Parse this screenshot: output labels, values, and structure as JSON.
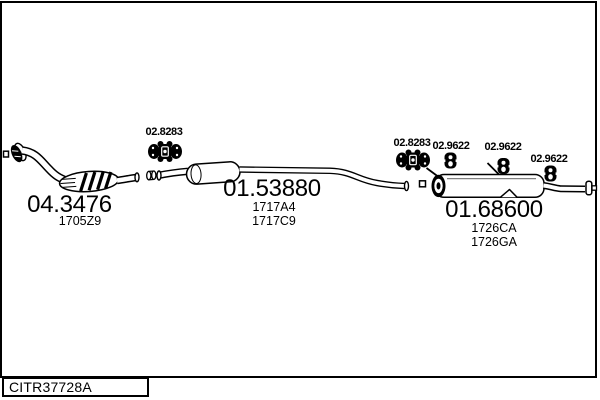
{
  "parts": [
    {
      "number": "04.3476",
      "subs": [
        "1705Z9"
      ]
    },
    {
      "number": "01.53880",
      "subs": [
        "1717A4",
        "1717C9"
      ]
    },
    {
      "number": "01.68600",
      "subs": [
        "1726CA",
        "1726GA"
      ]
    }
  ],
  "fittings": [
    {
      "id": "clamp-left",
      "label": "02.8283",
      "icon": "exhaust-clamp-icon"
    },
    {
      "id": "clamp-right",
      "label": "02.8283",
      "icon": "exhaust-clamp-icon"
    },
    {
      "id": "hanger-1",
      "label": "02.9622",
      "icon": "rubber-hanger-icon"
    },
    {
      "id": "hanger-2",
      "label": "02.9622",
      "icon": "rubber-hanger-icon"
    },
    {
      "id": "hanger-3",
      "label": "02.9622",
      "icon": "rubber-hanger-icon"
    }
  ],
  "footer": {
    "code": "CITR37728A"
  },
  "colors": {
    "line": "#000000",
    "background": "#ffffff"
  }
}
